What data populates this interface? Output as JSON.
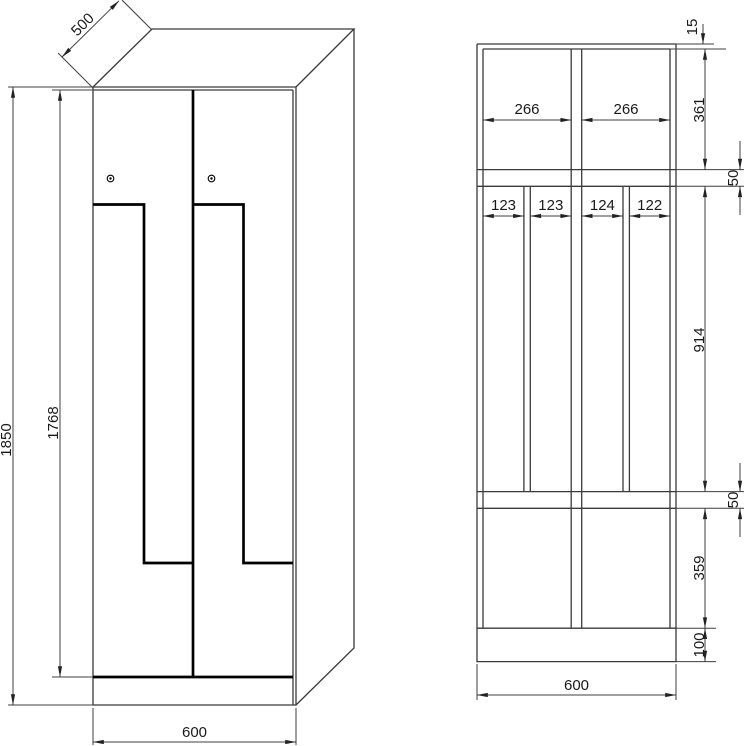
{
  "drawing": {
    "background": "#ffffff",
    "line_color": "#3a3a3a",
    "door_line_color": "#000000",
    "text_color": "#1a1a1a",
    "subject": "Z-door locker cabinet technical drawing"
  },
  "front_view": {
    "dims": {
      "depth": "500",
      "total_height": "1850",
      "door_height": "1768",
      "width": "600"
    }
  },
  "section_view": {
    "dims": {
      "top_panel_thickness": "15",
      "top_compartment_height": "361",
      "top_shelf_thickness": "50",
      "middle_section_height": "914",
      "bottom_shelf_thickness": "50",
      "bottom_compartment_height": "359",
      "plinth_height": "100",
      "top_compartment_widths": [
        "266",
        "266"
      ],
      "middle_column_widths": [
        "123",
        "123",
        "124",
        "122"
      ],
      "overall_width": "600"
    }
  }
}
